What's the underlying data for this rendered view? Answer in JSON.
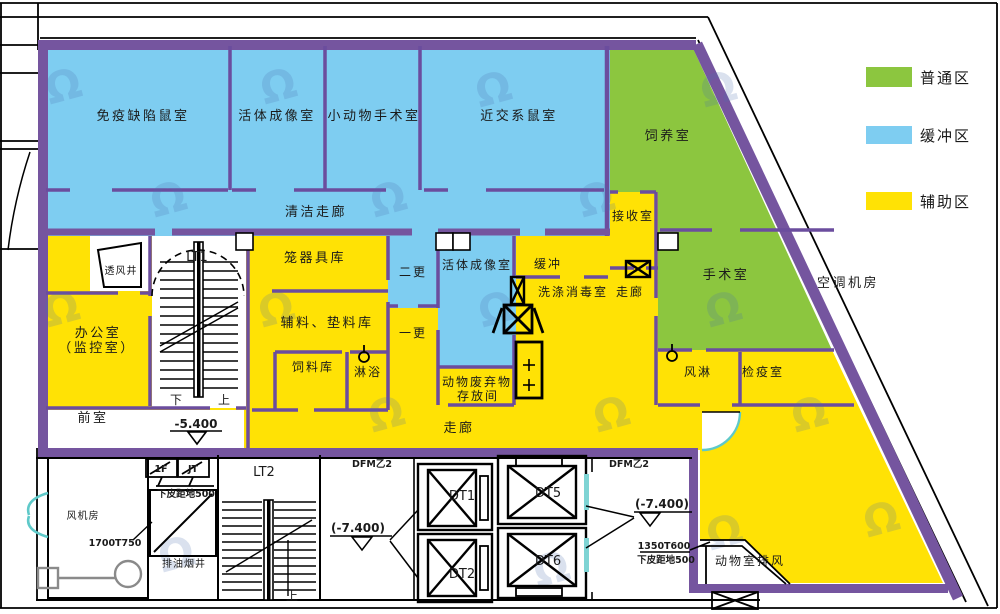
{
  "colors": {
    "zone_general_green": "#8cc63f",
    "zone_buffer_blue": "#7ecdf1",
    "zone_auxiliary_yellow": "#ffe205",
    "wall_purple": "#75559f",
    "door_teal": "#5fc9c9"
  },
  "legend": {
    "items": [
      {
        "label": "普通区",
        "color": "#8cc63f"
      },
      {
        "label": "缓冲区",
        "color": "#7ecdf1"
      },
      {
        "label": "辅助区",
        "color": "#ffe205"
      }
    ]
  },
  "rooms": {
    "immune_mouse": "免疫缺陷鼠室",
    "imaging_top": "活体成像室",
    "small_animal_surgery": "小动物手术室",
    "inbred_mouse": "近交系鼠室",
    "clean_corridor": "清洁走廊",
    "breeding": "饲养室",
    "receiving": "接收室",
    "surgery": "手术室",
    "buffer": "缓冲",
    "washing_disinfect": "洗涤消毒室",
    "corridor_vert": "走廊",
    "imaging_mid": "活体成像室",
    "second_change": "二更",
    "first_change": "一更",
    "cage_storage": "笼器具库",
    "aux_bedding_storage": "辅料、垫料库",
    "feed_storage": "饲料库",
    "shower": "淋浴",
    "animal_waste_line1": "动物废弃物",
    "animal_waste_line2": "存放间",
    "office_line1": "办公室",
    "office_line2": "（监控室）",
    "vent_shaft": "透风井",
    "front_room": "前室",
    "corridor_horiz": "走廊",
    "air_shower": "风淋",
    "quarantine": "检疫室",
    "ahu_room": "空调机房",
    "animal_exhaust": "动物室排风",
    "fan_room": "风机房",
    "smoke_exhaust_shaft": "排油烟井"
  },
  "stairs": {
    "lt1": "LT1",
    "lt2": "LT2",
    "dt1": "DT1",
    "dt2": "DT2",
    "dt5": "DT5",
    "dt6": "DT6",
    "down": "下",
    "up": "上",
    "up2": "上"
  },
  "annotations": {
    "level_main": "-5.400",
    "level_left": "(-7.400)",
    "level_right": "(-7.400)",
    "dfm_left": "DFM乙2",
    "dfm_right": "DFM乙2",
    "floor_1f": "1F",
    "jt": "JT",
    "clearance_left": "下皮距地500",
    "clearance_right": "下皮距地500",
    "duct_1700": "1700T750",
    "duct_1350": "1350T600"
  },
  "watermark": {
    "glyph": "Ω"
  }
}
